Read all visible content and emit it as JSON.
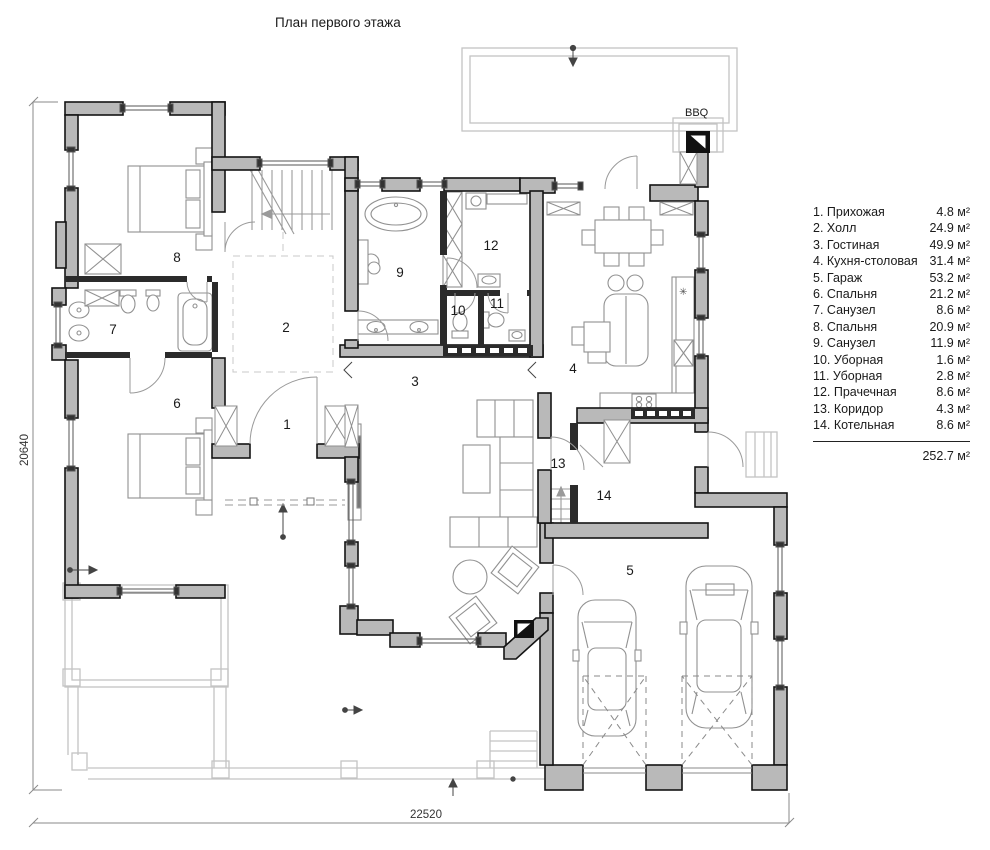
{
  "title": "План первого этажа",
  "bbq_label": "BBQ",
  "dimensions": {
    "height_mm": "20640",
    "width_mm": "22520"
  },
  "rooms": [
    {
      "num": "1"
    },
    {
      "num": "2"
    },
    {
      "num": "3"
    },
    {
      "num": "4"
    },
    {
      "num": "5"
    },
    {
      "num": "6"
    },
    {
      "num": "7"
    },
    {
      "num": "8"
    },
    {
      "num": "9"
    },
    {
      "num": "10"
    },
    {
      "num": "11"
    },
    {
      "num": "12"
    },
    {
      "num": "13"
    },
    {
      "num": "14"
    }
  ],
  "legend": {
    "items": [
      {
        "label": "1. Прихожая",
        "area": "4.8 м²"
      },
      {
        "label": "2. Холл",
        "area": "24.9 м²"
      },
      {
        "label": "3. Гостиная",
        "area": "49.9 м²"
      },
      {
        "label": "4. Кухня-столовая",
        "area": "31.4 м²"
      },
      {
        "label": "5. Гараж",
        "area": "53.2 м²"
      },
      {
        "label": "6. Спальня",
        "area": "21.2 м²"
      },
      {
        "label": "7. Санузел",
        "area": "8.6 м²"
      },
      {
        "label": "8. Спальня",
        "area": "20.9 м²"
      },
      {
        "label": "9. Санузел",
        "area": "11.9 м²"
      },
      {
        "label": "10. Уборная",
        "area": "1.6 м²"
      },
      {
        "label": "11. Уборная",
        "area": "2.8 м²"
      },
      {
        "label": "12. Прачечная",
        "area": "8.6 м²"
      },
      {
        "label": "13. Коридор",
        "area": "4.3 м²"
      },
      {
        "label": "14. Котельная",
        "area": "8.6 м²"
      }
    ],
    "total": "252.7 м²"
  },
  "kitchen": {
    "sink_symbol": "✳"
  }
}
